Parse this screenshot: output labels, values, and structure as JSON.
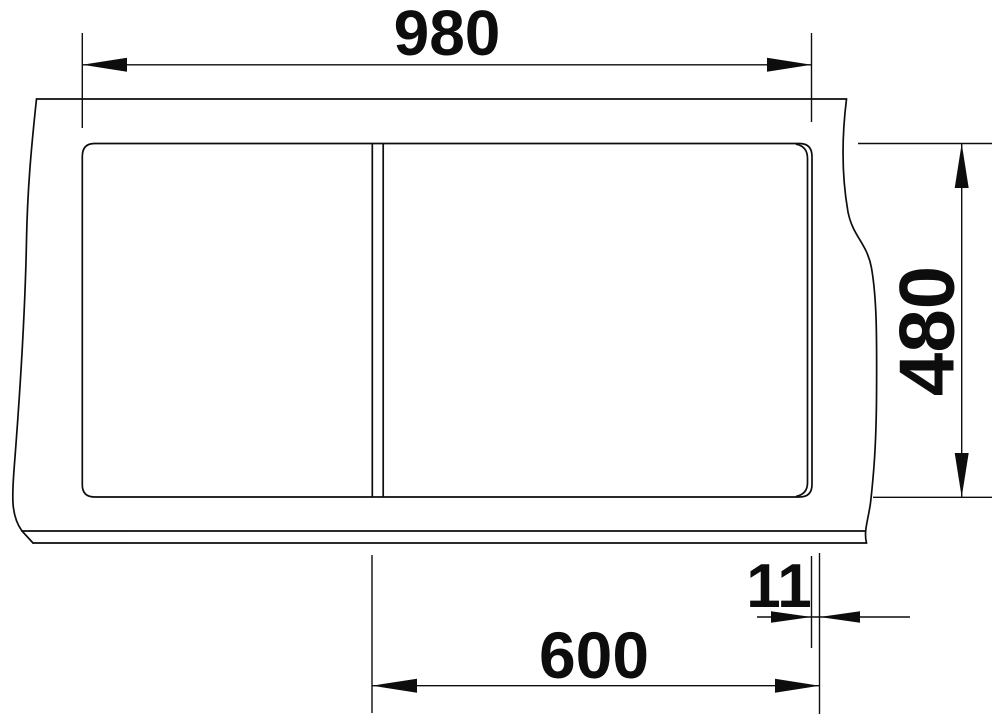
{
  "drawing": {
    "type": "sink-installation-top-view",
    "colors": {
      "line": "#0d0d0d",
      "background": "#ffffff"
    },
    "dimensions": {
      "overall_width": {
        "value": "980"
      },
      "overall_depth": {
        "value": "480"
      },
      "divider_to_right_edge": {
        "value": "600"
      },
      "rim_overhang": {
        "value": "11"
      }
    }
  }
}
